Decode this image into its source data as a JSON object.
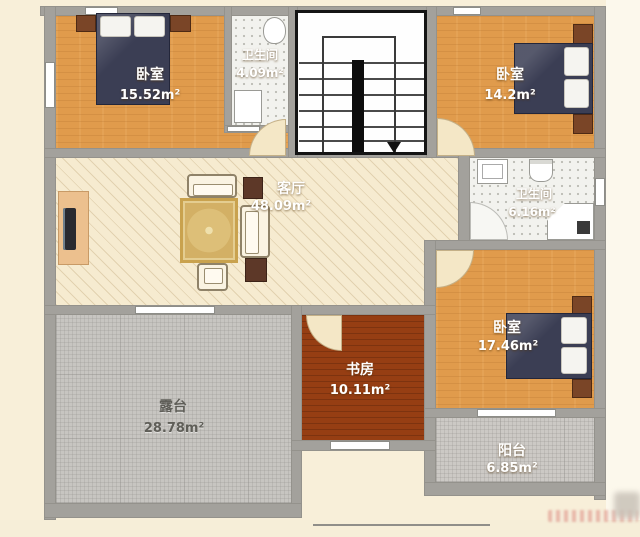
{
  "rooms": {
    "bedroom1": {
      "name": "卧室",
      "area": "15.52m²"
    },
    "bath1": {
      "name": "卫生间",
      "area": "4.09m²"
    },
    "bedroom2": {
      "name": "卧室",
      "area": "14.2m²"
    },
    "living": {
      "name": "客厅",
      "area": "48.09m²"
    },
    "bath2": {
      "name": "卫生间",
      "area": "6.16m²"
    },
    "bedroom3": {
      "name": "卧室",
      "area": "17.46m²"
    },
    "study": {
      "name": "书房",
      "area": "10.11m²"
    },
    "terrace": {
      "name": "露台",
      "area": "28.78m²"
    },
    "balcony": {
      "name": "阳台",
      "area": "6.85m²"
    }
  },
  "colors": {
    "wood_floor": "#e09b4c",
    "living_floor": "#f6ebd0",
    "study_floor": "#963e13",
    "outdoor_tile": "#c7c5c1",
    "bath_tile": "#f2f2ee",
    "wall": "#a3a19c",
    "bed": "#3b3e54",
    "room_label": "#ffffff",
    "terrace_label": "#5f5e58"
  }
}
